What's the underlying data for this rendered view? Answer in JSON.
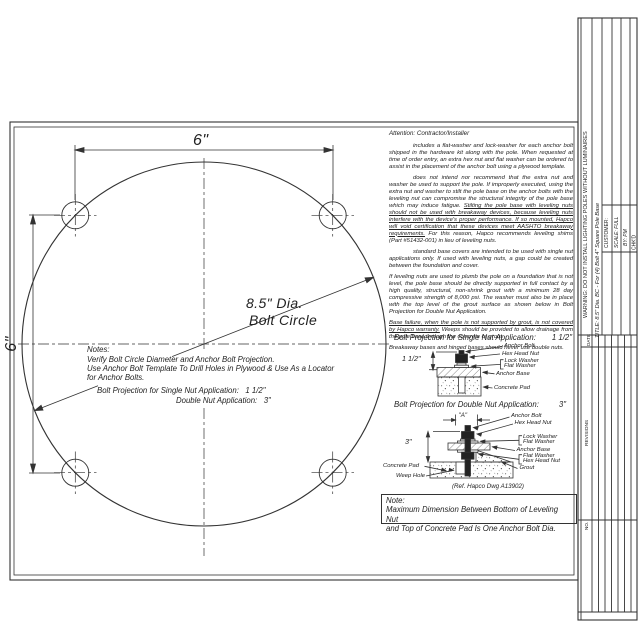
{
  "attention": {
    "heading": "Attention: Contractor/Installer",
    "p1": "includes a flat-washer and lock-washer for each anchor bolt shipped in the hardware kit along with the pole. When requested at time of order entry, an extra hex nut and flat washer can be ordered to assist in the placement of the anchor bolt using a plywood template.",
    "p2a": "does not intend nor recommend that the extra nut and washer be used to support the pole.  If improperly executed, using the extra nut and washer to stilt the pole base on the anchor bolts with the leveling nut can compromise the structural integrity of the pole base which may induce fatigue. ",
    "p2b": "Stilting the pole base with leveling nuts should not be used with breakaway devices, because leveling nuts interfere with the device's proper performance. If so mounted, Hapco will void certification that these devices meet AASHTO breakaway requirements.",
    "p2c": " For this reason, Hapco recommends leveling shims (Part #51432-001) in lieu of leveling nuts.",
    "p3": "standard base covers are intended to be used with single nut applications only.  If used with leveling nuts, a gap could be created between the foundation and cover.",
    "p4": "If leveling nuts are used to plumb the pole on a foundation that is not level, the pole base should be directly supported in full contact by a high quality, structural, non-shrink grout with a minimum 28 day compressive strength of 8,000 psi. The washer must also be in place with the top level of the grout surface as shown below in Bolt Projection for Double Nut Application.",
    "p5a": "Base failure, when the pole is not supported by grout, is not covered by Hapco warranty.",
    "p5b": "  Weeps should be provided to allow drainage from the pole base through the concrete or grout.",
    "p6": "Breakaway bases and hinged bases should never use double nuts."
  },
  "drawing": {
    "dim_top": "6\"",
    "dim_left": "6\"",
    "dia_label_1": "8.5\" Dia.",
    "dia_label_2": "Bolt Circle"
  },
  "notes": {
    "heading": "Notes:",
    "line1": "Verify Bolt Circle Diameter and Anchor Bolt Projection.",
    "line2": "Use Anchor Bolt Template To Drill Holes in Plywood & Use As a Locator",
    "line3": "for Anchor Bolts.",
    "single_label": "Bolt Projection for Single Nut Application:",
    "single_value": "1 1/2\"",
    "double_label": "Double Nut Application:",
    "double_value": "3\""
  },
  "single_nut": {
    "heading": "Bolt Projection for Single Nut Application:",
    "heading_value": "1 1/2\"",
    "dim": "1 1/2\"",
    "labels": {
      "anchor_bolt": "Anchor Bolt",
      "hex_head_nut": "Hex Head Nut",
      "lock_washer": "Lock Washer",
      "flat_washer": "Flat Washer",
      "anchor_base": "Anchor Base",
      "concrete_pad": "Concrete Pad"
    }
  },
  "double_nut": {
    "heading": "Bolt Projection for Double Nut Application:",
    "heading_value": "3\"",
    "dim_a": "\"A\"",
    "dim_3": "3\"",
    "labels": {
      "anchor_bolt": "Anchor Bolt",
      "hex_head_nut_top": "Hex Head Nut",
      "lock_washer": "Lock Washer",
      "flat_washer_top": "Flat Washer",
      "anchor_base": "Anchor Base",
      "flat_washer_bottom": "Flat Washer",
      "hex_head_nut_bottom": "Hex Head Nut",
      "grout": "Grout",
      "concrete_pad": "Concrete Pad",
      "weep_hole": "Weep Hole"
    },
    "ref": "(Ref. Hapco Dwg A13902)"
  },
  "note_box": {
    "heading": "Note:",
    "line1": "Maximum Dimension Between Bottom of Leveling Nut",
    "line2": "and Top of Concrete Pad Is One Anchor Bolt Dia."
  },
  "title_block": {
    "warning": "WARNING:  DO  NOT  INSTALL  LIGHTING  POLES  WITHOUT  LUMINAIRES",
    "title": "TITLE:  8.5\" Dia. BC  -  For (4) Bolt 4\" Square Pole Base",
    "customer": "CUSTOMER:",
    "scale": "SCALE:  FULL",
    "by": "BY:  PM",
    "chkd": "CHK'D",
    "date": "DATE",
    "revisions": "REVISIONS",
    "no": "NO."
  },
  "colors": {
    "ink": "#333333",
    "paper": "#ffffff"
  }
}
